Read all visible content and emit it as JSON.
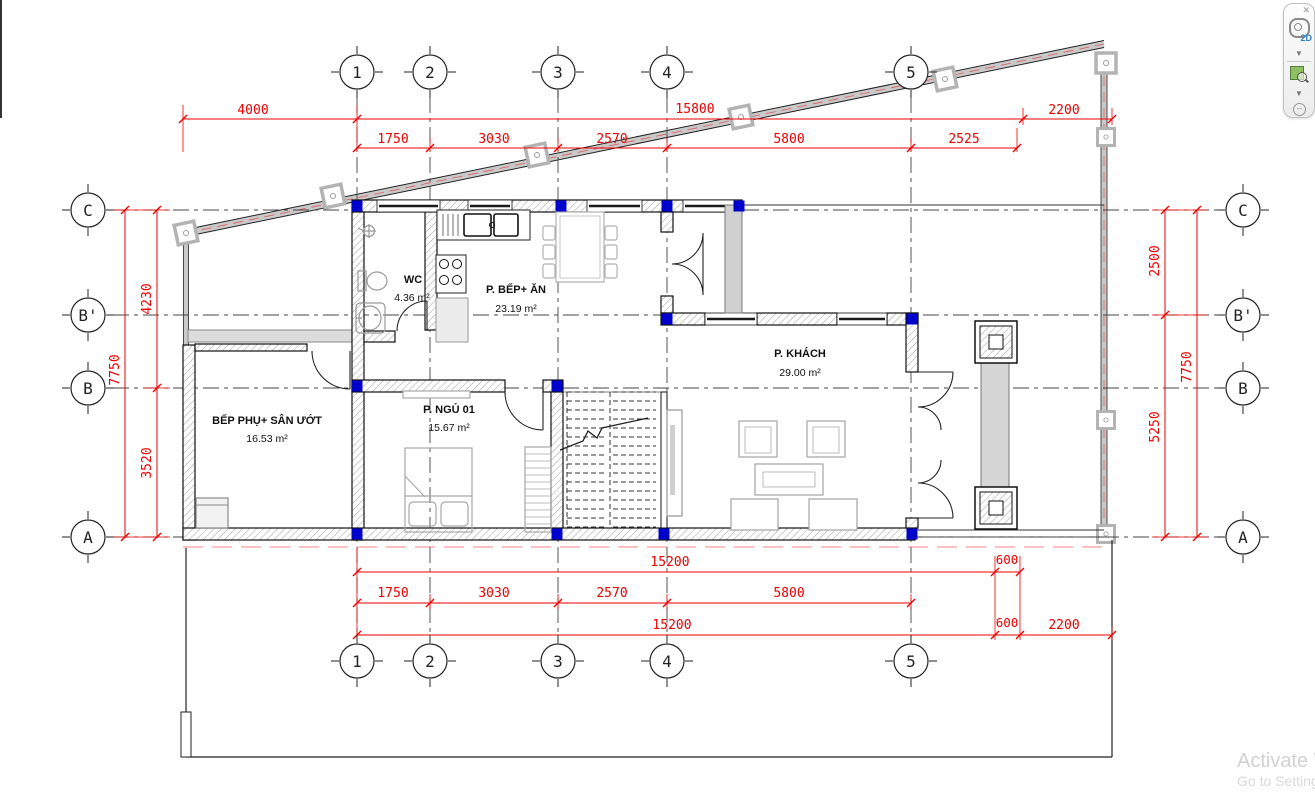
{
  "plan": {
    "rooms": {
      "wc": {
        "name": "WC",
        "area": "4.36 m²"
      },
      "kitchen": {
        "name": "P. BẾP+ ĂN",
        "area": "23.19 m²"
      },
      "living": {
        "name": "P. KHÁCH",
        "area": "29.00 m²"
      },
      "bedroom": {
        "name": "P. NGỦ 01",
        "area": "15.67 m²"
      },
      "back_kitchen": {
        "name": "BẾP PHỤ+ SÂN ƯỚT",
        "area": "16.53 m²"
      }
    },
    "grid": {
      "columns": {
        "c1": "1",
        "c2": "2",
        "c3": "3",
        "c4": "4",
        "c5": "5"
      },
      "rows": {
        "C": "C",
        "Bp": "B'",
        "B": "B",
        "A": "A"
      }
    },
    "dims": {
      "top_row_outer": {
        "d4000": "4000",
        "d15800": "15800",
        "d2200": "2200"
      },
      "top_row_inner": {
        "d1750": "1750",
        "d3030": "3030",
        "d2570": "2570",
        "d5800": "5800",
        "d2525": "2525"
      },
      "bottom_row_inner1": {
        "d15200": "15200",
        "d600": "600"
      },
      "bottom_row_inner2": {
        "d1750": "1750",
        "d3030": "3030",
        "d2570": "2570",
        "d5800": "5800"
      },
      "bottom_row_outer": {
        "d15200": "15200",
        "d600": "600",
        "d2200": "2200"
      },
      "left": {
        "d4230": "4230",
        "d7750": "7750",
        "d3520": "3520"
      },
      "right": {
        "d2500": "2500",
        "d7750": "7750",
        "d5250": "5250"
      }
    }
  },
  "navigation_bar": {
    "wheel_label": "2D",
    "icons": [
      "close-icon",
      "steering-wheel-2d-icon",
      "chevron-down-icon",
      "zoom-region-icon",
      "chevron-down-icon",
      "minus-icon"
    ]
  },
  "watermark": {
    "line1": "Activate W",
    "line2": "Go to Setting"
  },
  "colors": {
    "dimension_red": "#ee0000",
    "column_blue": "#0000cd",
    "fence_gray": "#c9c9c9",
    "watermark_gray": "#d2d2d2",
    "nav_green": "#8fbe63",
    "boundary_pink": "#ffadad"
  }
}
